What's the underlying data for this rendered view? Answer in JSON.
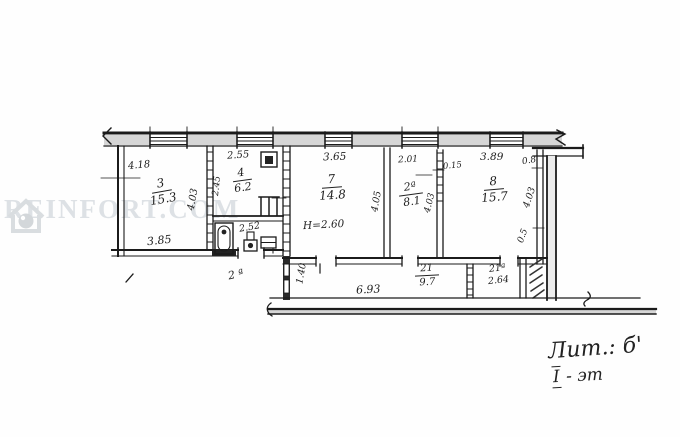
{
  "watermark": {
    "text": "REINFORT.COM"
  },
  "rooms": {
    "r3": {
      "number": "3",
      "area": "15.3"
    },
    "r4": {
      "number": "4",
      "area": "6.2"
    },
    "bath": {
      "area": "2.52"
    },
    "r7": {
      "number": "7",
      "area": "14.8",
      "height": "H=2.60"
    },
    "r2a": {
      "number": "2ª",
      "area": "8.1"
    },
    "r8": {
      "number": "8",
      "area": "15.7"
    },
    "r21": {
      "number": "21",
      "area": "9.7"
    },
    "r21a": {
      "number": "21ª",
      "area": "2.64"
    },
    "porch": {
      "number": "2 ª"
    }
  },
  "dims": {
    "room3_top": "4.18",
    "room3_bottom": "3.85",
    "room3_right": "4.03",
    "kitchen_top": "2.55",
    "kitchen_left": "2.45",
    "room7_top": "3.65",
    "room7_right": "4.05",
    "room2a_top": "2.01",
    "wall_thickness": "0.15",
    "room2a_right": "4.03",
    "room8_top": "3.89",
    "room8_top_right": "0.8",
    "room8_right": "4.03",
    "room8_lower": "0.5",
    "hall_left": "1.40",
    "hall_bottom": "6.93"
  },
  "notes": {
    "litera": "Лит.: б'",
    "floor_roman": "I",
    "floor_text": "- эт"
  },
  "colors": {
    "ink": "#1b1b1b",
    "wall_fill": "#d6d6d6",
    "watermark": "#dde1e5"
  }
}
